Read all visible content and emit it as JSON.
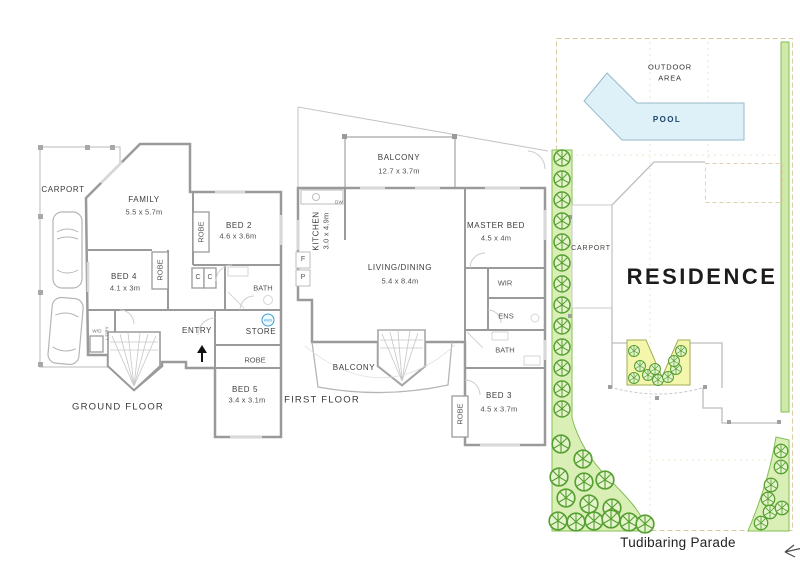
{
  "ground": {
    "title": "GROUND FLOOR",
    "carport": "CARPORT",
    "family": {
      "name": "FAMILY",
      "dims": "5.5 x 5.7m"
    },
    "bed2": {
      "name": "BED 2",
      "dims": "4.6 x 3.6m"
    },
    "bed4": {
      "name": "BED 4",
      "dims": "4.1 x 3m"
    },
    "bed5": {
      "name": "BED 5",
      "dims": "3.4 x 3.1m"
    },
    "bath": "BATH",
    "entry": "ENTRY",
    "store": "STORE",
    "robe1": "ROBE",
    "robe2": "ROBE",
    "robe3": "ROBE",
    "laundry": "L'DRY",
    "wd": "W/D",
    "c1": "C",
    "c2": "C",
    "hws": "HWS"
  },
  "first": {
    "title": "FIRST FLOOR",
    "balcony_top": {
      "name": "BALCONY",
      "dims": "12.7 x 3.7m"
    },
    "kitchen": {
      "name": "KITCHEN",
      "dims": "3.0 x 4.9m"
    },
    "living": {
      "name": "LIVING/DINING",
      "dims": "5.4 x 8.4m"
    },
    "master": {
      "name": "MASTER BED",
      "dims": "4.5 x 4m"
    },
    "bed3": {
      "name": "BED 3",
      "dims": "4.5 x 3.7m"
    },
    "wir": "WIR",
    "ens": "ENS",
    "bath": "BATH",
    "balcony_bottom": "BALCONY",
    "robe": "ROBE",
    "dw": "DW",
    "fridge": "F",
    "pantry": "P"
  },
  "site": {
    "outdoor_area": "OUTDOOR\nAREA",
    "pool": "POOL",
    "carport": "CARPORT",
    "residence": "RESIDENCE",
    "street": "Tudibaring Parade"
  },
  "colors": {
    "wall_grey": "#9a9a9a",
    "light_line": "#c9c9c9",
    "label_grey": "#3d3d3d",
    "pool_fill": "#def1f8",
    "pool_stroke": "#98bac8",
    "pool_text": "#1c4468",
    "grass_fill": "#d9efb6",
    "grass_stroke": "#84bf55",
    "tree_green": "#57a032",
    "garden_bed_fill": "#f3f6ab",
    "boundary_tan": "#d8c9a3",
    "hws_blue": "#2f96c8"
  }
}
